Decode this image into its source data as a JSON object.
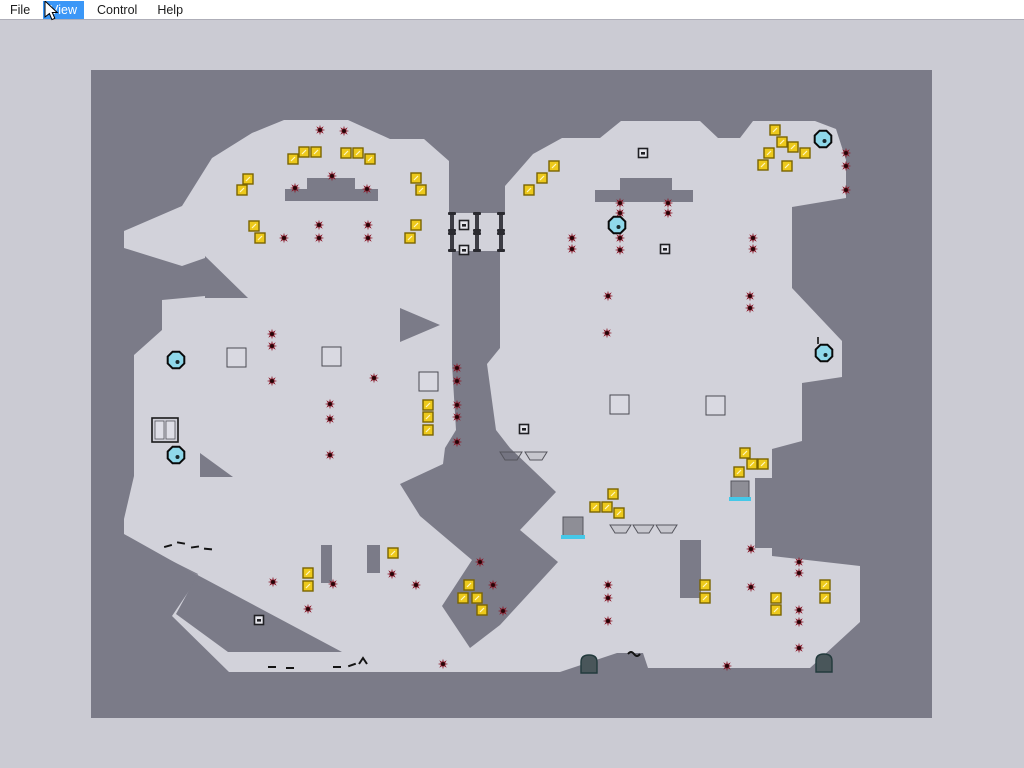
{
  "menu": {
    "items": [
      {
        "label": "File",
        "selected": false
      },
      {
        "label": "View",
        "selected": true
      },
      {
        "label": "Control",
        "selected": false
      },
      {
        "label": "Help",
        "selected": false
      }
    ]
  },
  "hud": {
    "timer_text": ""
  },
  "dialog": {
    "title": "Game Over: Out of Time!",
    "subtitle": "(press Jump to retry, Back to exit)"
  },
  "colors": {
    "window_bg": "#cbcbd3",
    "viewport_bg": "#7b7b88",
    "tile": "#d2d2da",
    "menu_highlight": "#3b97f7",
    "gold_fill": "#edc91c",
    "gold_stroke": "#7a6400",
    "mine_fill": "#8a1525",
    "mine_core": "#240508",
    "drone_fill": "#8fd8ea",
    "drone_stroke": "#0a0a0a",
    "thwump_fill": "#8e8e96",
    "thwump_edge": "#45c8e8",
    "bounce_fill": "#d9d9e1",
    "bounce_stroke": "#4a4a52",
    "door_fill": "#3c3c44",
    "turret_fill": "#49565a",
    "turret_stroke": "#223a3c",
    "debris": "#141414"
  },
  "map": {
    "terrain": {
      "light": [
        [
          [
            124,
            231
          ],
          [
            182,
            206
          ],
          [
            212,
            158
          ],
          [
            252,
            133
          ],
          [
            284,
            120
          ],
          [
            348,
            120
          ],
          [
            390,
            139
          ],
          [
            424,
            139
          ],
          [
            449,
            161
          ],
          [
            449,
            213
          ],
          [
            505,
            213
          ],
          [
            505,
            186
          ],
          [
            533,
            154
          ],
          [
            562,
            138
          ],
          [
            600,
            138
          ],
          [
            621,
            121
          ],
          [
            700,
            121
          ],
          [
            718,
            138
          ],
          [
            740,
            138
          ],
          [
            753,
            121
          ],
          [
            815,
            121
          ],
          [
            836,
            129
          ],
          [
            846,
            160
          ],
          [
            846,
            198
          ],
          [
            792,
            207
          ],
          [
            792,
            288
          ],
          [
            842,
            341
          ],
          [
            842,
            377
          ],
          [
            802,
            383
          ],
          [
            802,
            441
          ],
          [
            772,
            449
          ],
          [
            772,
            556
          ],
          [
            860,
            566
          ],
          [
            860,
            622
          ],
          [
            810,
            668
          ],
          [
            648,
            668
          ],
          [
            643,
            653
          ],
          [
            617,
            653
          ],
          [
            560,
            672
          ],
          [
            229,
            672
          ],
          [
            172,
            616
          ],
          [
            199,
            576
          ],
          [
            124,
            534
          ],
          [
            124,
            519
          ],
          [
            134,
            476
          ],
          [
            134,
            355
          ],
          [
            162,
            330
          ],
          [
            162,
            300
          ],
          [
            205,
            296
          ],
          [
            205,
            258
          ],
          [
            182,
            266
          ],
          [
            124,
            248
          ]
        ]
      ],
      "dark": [
        {
          "rect": [
            307,
            178,
            48,
            11
          ]
        },
        {
          "rect": [
            285,
            189,
            93,
            12
          ]
        },
        {
          "rect": [
            620,
            178,
            52,
            12
          ]
        },
        {
          "rect": [
            595,
            190,
            98,
            12
          ]
        },
        {
          "poly": [
            [
              452,
              251
            ],
            [
              500,
              251
            ],
            [
              500,
              348
            ],
            [
              487,
              364
            ],
            [
              496,
              430
            ],
            [
              510,
              448
            ],
            [
              445,
              448
            ],
            [
              456,
              430
            ],
            [
              452,
              364
            ]
          ]
        },
        {
          "poly": [
            [
              445,
              448
            ],
            [
              510,
              448
            ],
            [
              556,
              492
            ],
            [
              520,
              530
            ],
            [
              558,
              562
            ],
            [
              500,
              625
            ],
            [
              470,
              648
            ],
            [
              442,
              606
            ],
            [
              472,
              560
            ],
            [
              420,
              516
            ],
            [
              400,
              484
            ],
            [
              443,
              464
            ]
          ]
        },
        {
          "poly": [
            [
              158,
              554
            ],
            [
              342,
              652
            ],
            [
              228,
              652
            ],
            [
              176,
              614
            ],
            [
              198,
              574
            ]
          ]
        },
        {
          "rect": [
            321,
            545,
            11,
            38
          ]
        },
        {
          "rect": [
            367,
            545,
            13,
            28
          ]
        },
        {
          "rect": [
            680,
            540,
            21,
            58
          ]
        },
        {
          "rect": [
            755,
            478,
            20,
            70
          ]
        },
        {
          "poly": [
            [
              205,
              256
            ],
            [
              248,
              298
            ],
            [
              205,
              298
            ]
          ]
        },
        {
          "poly": [
            [
              400,
              308
            ],
            [
              440,
              325
            ],
            [
              400,
              342
            ]
          ]
        },
        {
          "poly": [
            [
              200,
              453
            ],
            [
              233,
              477
            ],
            [
              200,
              477
            ]
          ]
        }
      ]
    },
    "gold": [
      [
        293,
        159
      ],
      [
        304,
        152
      ],
      [
        316,
        152
      ],
      [
        346,
        153
      ],
      [
        358,
        153
      ],
      [
        370,
        159
      ],
      [
        248,
        179
      ],
      [
        242,
        190
      ],
      [
        254,
        226
      ],
      [
        260,
        238
      ],
      [
        416,
        178
      ],
      [
        421,
        190
      ],
      [
        416,
        225
      ],
      [
        410,
        238
      ],
      [
        428,
        405
      ],
      [
        428,
        417
      ],
      [
        428,
        430
      ],
      [
        529,
        190
      ],
      [
        542,
        178
      ],
      [
        554,
        166
      ],
      [
        775,
        130
      ],
      [
        782,
        142
      ],
      [
        793,
        147
      ],
      [
        769,
        153
      ],
      [
        805,
        153
      ],
      [
        763,
        165
      ],
      [
        787,
        166
      ],
      [
        613,
        494
      ],
      [
        595,
        507
      ],
      [
        607,
        507
      ],
      [
        619,
        513
      ],
      [
        745,
        453
      ],
      [
        752,
        464
      ],
      [
        763,
        464
      ],
      [
        739,
        472
      ],
      [
        308,
        573
      ],
      [
        308,
        586
      ],
      [
        393,
        553
      ],
      [
        469,
        585
      ],
      [
        463,
        598
      ],
      [
        477,
        598
      ],
      [
        482,
        610
      ],
      [
        705,
        585
      ],
      [
        705,
        598
      ],
      [
        776,
        598
      ],
      [
        776,
        610
      ],
      [
        825,
        585
      ],
      [
        825,
        598
      ]
    ],
    "mines": [
      [
        320,
        130
      ],
      [
        344,
        131
      ],
      [
        332,
        176
      ],
      [
        295,
        188
      ],
      [
        367,
        189
      ],
      [
        319,
        225
      ],
      [
        319,
        238
      ],
      [
        368,
        225
      ],
      [
        368,
        238
      ],
      [
        284,
        238
      ],
      [
        272,
        334
      ],
      [
        272,
        346
      ],
      [
        272,
        381
      ],
      [
        374,
        378
      ],
      [
        330,
        404
      ],
      [
        330,
        419
      ],
      [
        330,
        455
      ],
      [
        457,
        368
      ],
      [
        457,
        381
      ],
      [
        457,
        405
      ],
      [
        457,
        417
      ],
      [
        457,
        442
      ],
      [
        572,
        238
      ],
      [
        572,
        249
      ],
      [
        620,
        203
      ],
      [
        620,
        213
      ],
      [
        620,
        238
      ],
      [
        620,
        250
      ],
      [
        668,
        203
      ],
      [
        668,
        213
      ],
      [
        753,
        238
      ],
      [
        753,
        249
      ],
      [
        608,
        296
      ],
      [
        607,
        333
      ],
      [
        750,
        296
      ],
      [
        750,
        308
      ],
      [
        846,
        153
      ],
      [
        846,
        166
      ],
      [
        846,
        190
      ],
      [
        273,
        582
      ],
      [
        308,
        609
      ],
      [
        333,
        584
      ],
      [
        392,
        574
      ],
      [
        416,
        585
      ],
      [
        480,
        562
      ],
      [
        493,
        585
      ],
      [
        503,
        611
      ],
      [
        443,
        664
      ],
      [
        608,
        585
      ],
      [
        608,
        598
      ],
      [
        608,
        621
      ],
      [
        751,
        549
      ],
      [
        751,
        587
      ],
      [
        799,
        562
      ],
      [
        799,
        573
      ],
      [
        799,
        610
      ],
      [
        799,
        622
      ],
      [
        799,
        648
      ],
      [
        727,
        666
      ]
    ],
    "drones": [
      [
        617,
        225
      ],
      [
        823,
        139
      ],
      [
        176,
        360
      ],
      [
        176,
        455
      ],
      [
        824,
        353
      ]
    ],
    "thwumps": [
      {
        "x": 563,
        "y": 517,
        "w": 20,
        "h": 19
      },
      {
        "x": 731,
        "y": 481,
        "w": 18,
        "h": 17
      }
    ],
    "bounce_blocks": [
      {
        "x": 227,
        "y": 348,
        "s": 19
      },
      {
        "x": 322,
        "y": 347,
        "s": 19
      },
      {
        "x": 419,
        "y": 372,
        "s": 19
      },
      {
        "x": 610,
        "y": 395,
        "s": 19
      },
      {
        "x": 706,
        "y": 396,
        "s": 19
      }
    ],
    "oneway_platforms": [
      {
        "x": 500,
        "y": 452,
        "w": 22
      },
      {
        "x": 525,
        "y": 452,
        "w": 22
      },
      {
        "x": 610,
        "y": 525,
        "w": 21
      },
      {
        "x": 633,
        "y": 525,
        "w": 21
      },
      {
        "x": 656,
        "y": 525,
        "w": 21
      }
    ],
    "doors": [
      {
        "x": 452,
        "y1": 214,
        "y2": 234,
        "seg": 16
      },
      {
        "x": 477,
        "y1": 214,
        "y2": 234,
        "seg": 16
      },
      {
        "x": 501,
        "y1": 214,
        "y2": 234,
        "seg": 16
      }
    ],
    "switches": [
      [
        464,
        225
      ],
      [
        464,
        250
      ],
      [
        524,
        429
      ],
      [
        643,
        153
      ],
      [
        665,
        249
      ],
      [
        259,
        620
      ]
    ],
    "turrets": [
      [
        589,
        664
      ],
      [
        824,
        663
      ]
    ],
    "exit_door": {
      "x": 152,
      "y": 418,
      "w": 26,
      "h": 24
    },
    "debris": [
      {
        "t": "mark",
        "x": 168,
        "y": 546,
        "a": -15
      },
      {
        "t": "mark",
        "x": 181,
        "y": 543,
        "a": 10
      },
      {
        "t": "mark",
        "x": 195,
        "y": 547,
        "a": -8
      },
      {
        "t": "mark",
        "x": 208,
        "y": 549,
        "a": 5
      },
      {
        "t": "mark",
        "x": 272,
        "y": 667,
        "a": 0
      },
      {
        "t": "mark",
        "x": 290,
        "y": 668,
        "a": 0
      },
      {
        "t": "mark",
        "x": 337,
        "y": 667,
        "a": 0
      },
      {
        "t": "mark",
        "x": 352,
        "y": 665,
        "a": -20
      },
      {
        "t": "caret",
        "x": 363,
        "y": 661,
        "a": 0
      },
      {
        "t": "tilde",
        "x": 634,
        "y": 653,
        "a": 0
      },
      {
        "t": "tick",
        "x": 818,
        "y": 344,
        "a": 0
      }
    ]
  }
}
